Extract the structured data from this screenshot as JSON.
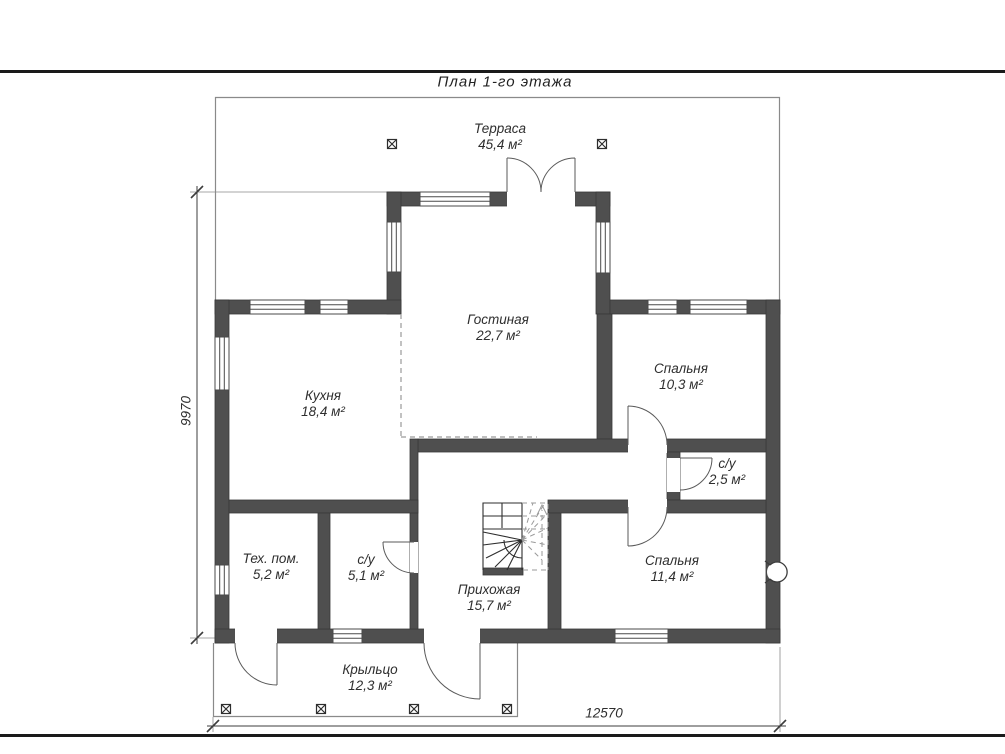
{
  "page": {
    "title": "План 1-го этажа"
  },
  "rooms": [
    {
      "name": "Терраса",
      "area": "45,4 м²"
    },
    {
      "name": "Гостиная",
      "area": "22,7 м²"
    },
    {
      "name": "Кухня",
      "area": "18,4 м²"
    },
    {
      "name": "Спальня",
      "area": "10,3 м²"
    },
    {
      "name": "с/у",
      "area": "2,5 м²"
    },
    {
      "name": "Тех. пом.",
      "area": "5,2 м²"
    },
    {
      "name": "с/у",
      "area": "5,1 м²"
    },
    {
      "name": "Прихожая",
      "area": "15,7 м²"
    },
    {
      "name": "Спальня",
      "area": "11,4 м²"
    },
    {
      "name": "Крыльцо",
      "area": "12,3 м²"
    }
  ],
  "dimensions": {
    "vertical": "9970",
    "horizontal": "12570"
  },
  "icons": {
    "column_marker": "crossed-square",
    "stairs_direction": "dashed-up-arrow",
    "vent_symbol": "notched-circle"
  },
  "colors": {
    "wall": "#4f4f4f",
    "thin_outline": "#8a8a8a",
    "dashed_line": "#9a9a9a",
    "dimension_line": "#3c3c3c",
    "text": "#2e2e2e"
  }
}
